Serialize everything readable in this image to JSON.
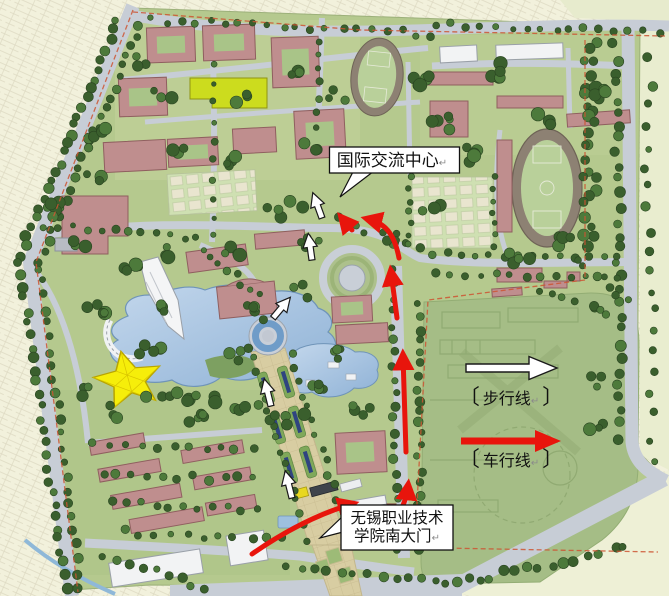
{
  "figure": {
    "kind": "campus-master-plan"
  },
  "callouts": {
    "exchange_center": {
      "text": "国际交流中心",
      "return_mark": "↵"
    },
    "south_gate": {
      "line1": "无锡职业技术",
      "line2": "学院南大门",
      "return_mark": "↵"
    }
  },
  "legend": {
    "walk": {
      "label": "步行线",
      "bracket_open": "〔",
      "bracket_close": "〕",
      "return_mark": "↵",
      "arrow_color": "#ffffff"
    },
    "vehicle": {
      "label": "车行线",
      "bracket_open": "〔",
      "bracket_close": "〕",
      "return_mark": "↵",
      "arrow_color": "#e8150c"
    }
  },
  "colors": {
    "route_walk": "#ffffff",
    "route_vehicle": "#e8150c",
    "boundary_line": "#cc5533",
    "lake": "#a9c6e4",
    "building": "#bf8e8e",
    "highlight_building": "#ccdc1e",
    "canopy_star": "#f6ee0a"
  }
}
